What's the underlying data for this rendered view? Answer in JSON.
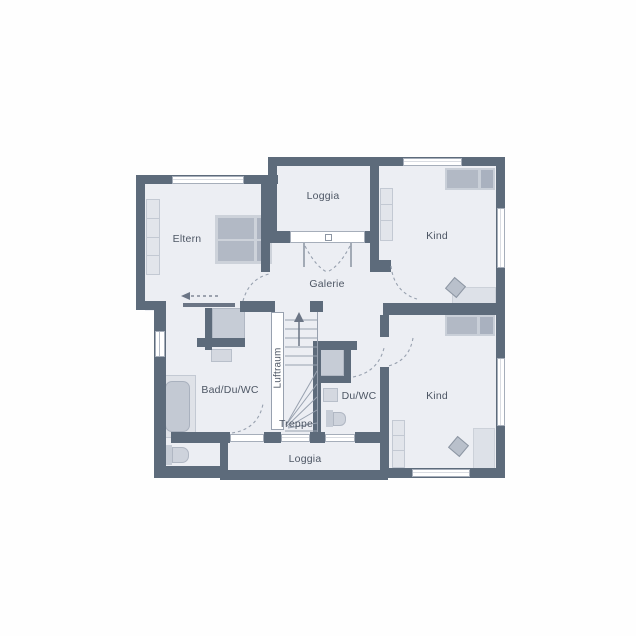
{
  "plan": {
    "rooms": {
      "eltern": {
        "label": "Eltern"
      },
      "loggia_top": {
        "label": "Loggia"
      },
      "kind_top": {
        "label": "Kind"
      },
      "galerie": {
        "label": "Galerie"
      },
      "luftraum": {
        "label": "Luftraum"
      },
      "bad": {
        "label": "Bad/Du/WC"
      },
      "treppe": {
        "label": "Treppe"
      },
      "du_wc": {
        "label": "Du/WC"
      },
      "kind_bottom": {
        "label": "Kind"
      },
      "loggia_bottom": {
        "label": "Loggia"
      }
    },
    "colors": {
      "wall": "#5d6b7b",
      "floor": "#eceef3",
      "furniture_mid": "#b2b9c5",
      "furniture_light": "#dfe2e9",
      "line": "#98a1af",
      "label_text": "#4d5664",
      "background": "#fefefe"
    }
  }
}
